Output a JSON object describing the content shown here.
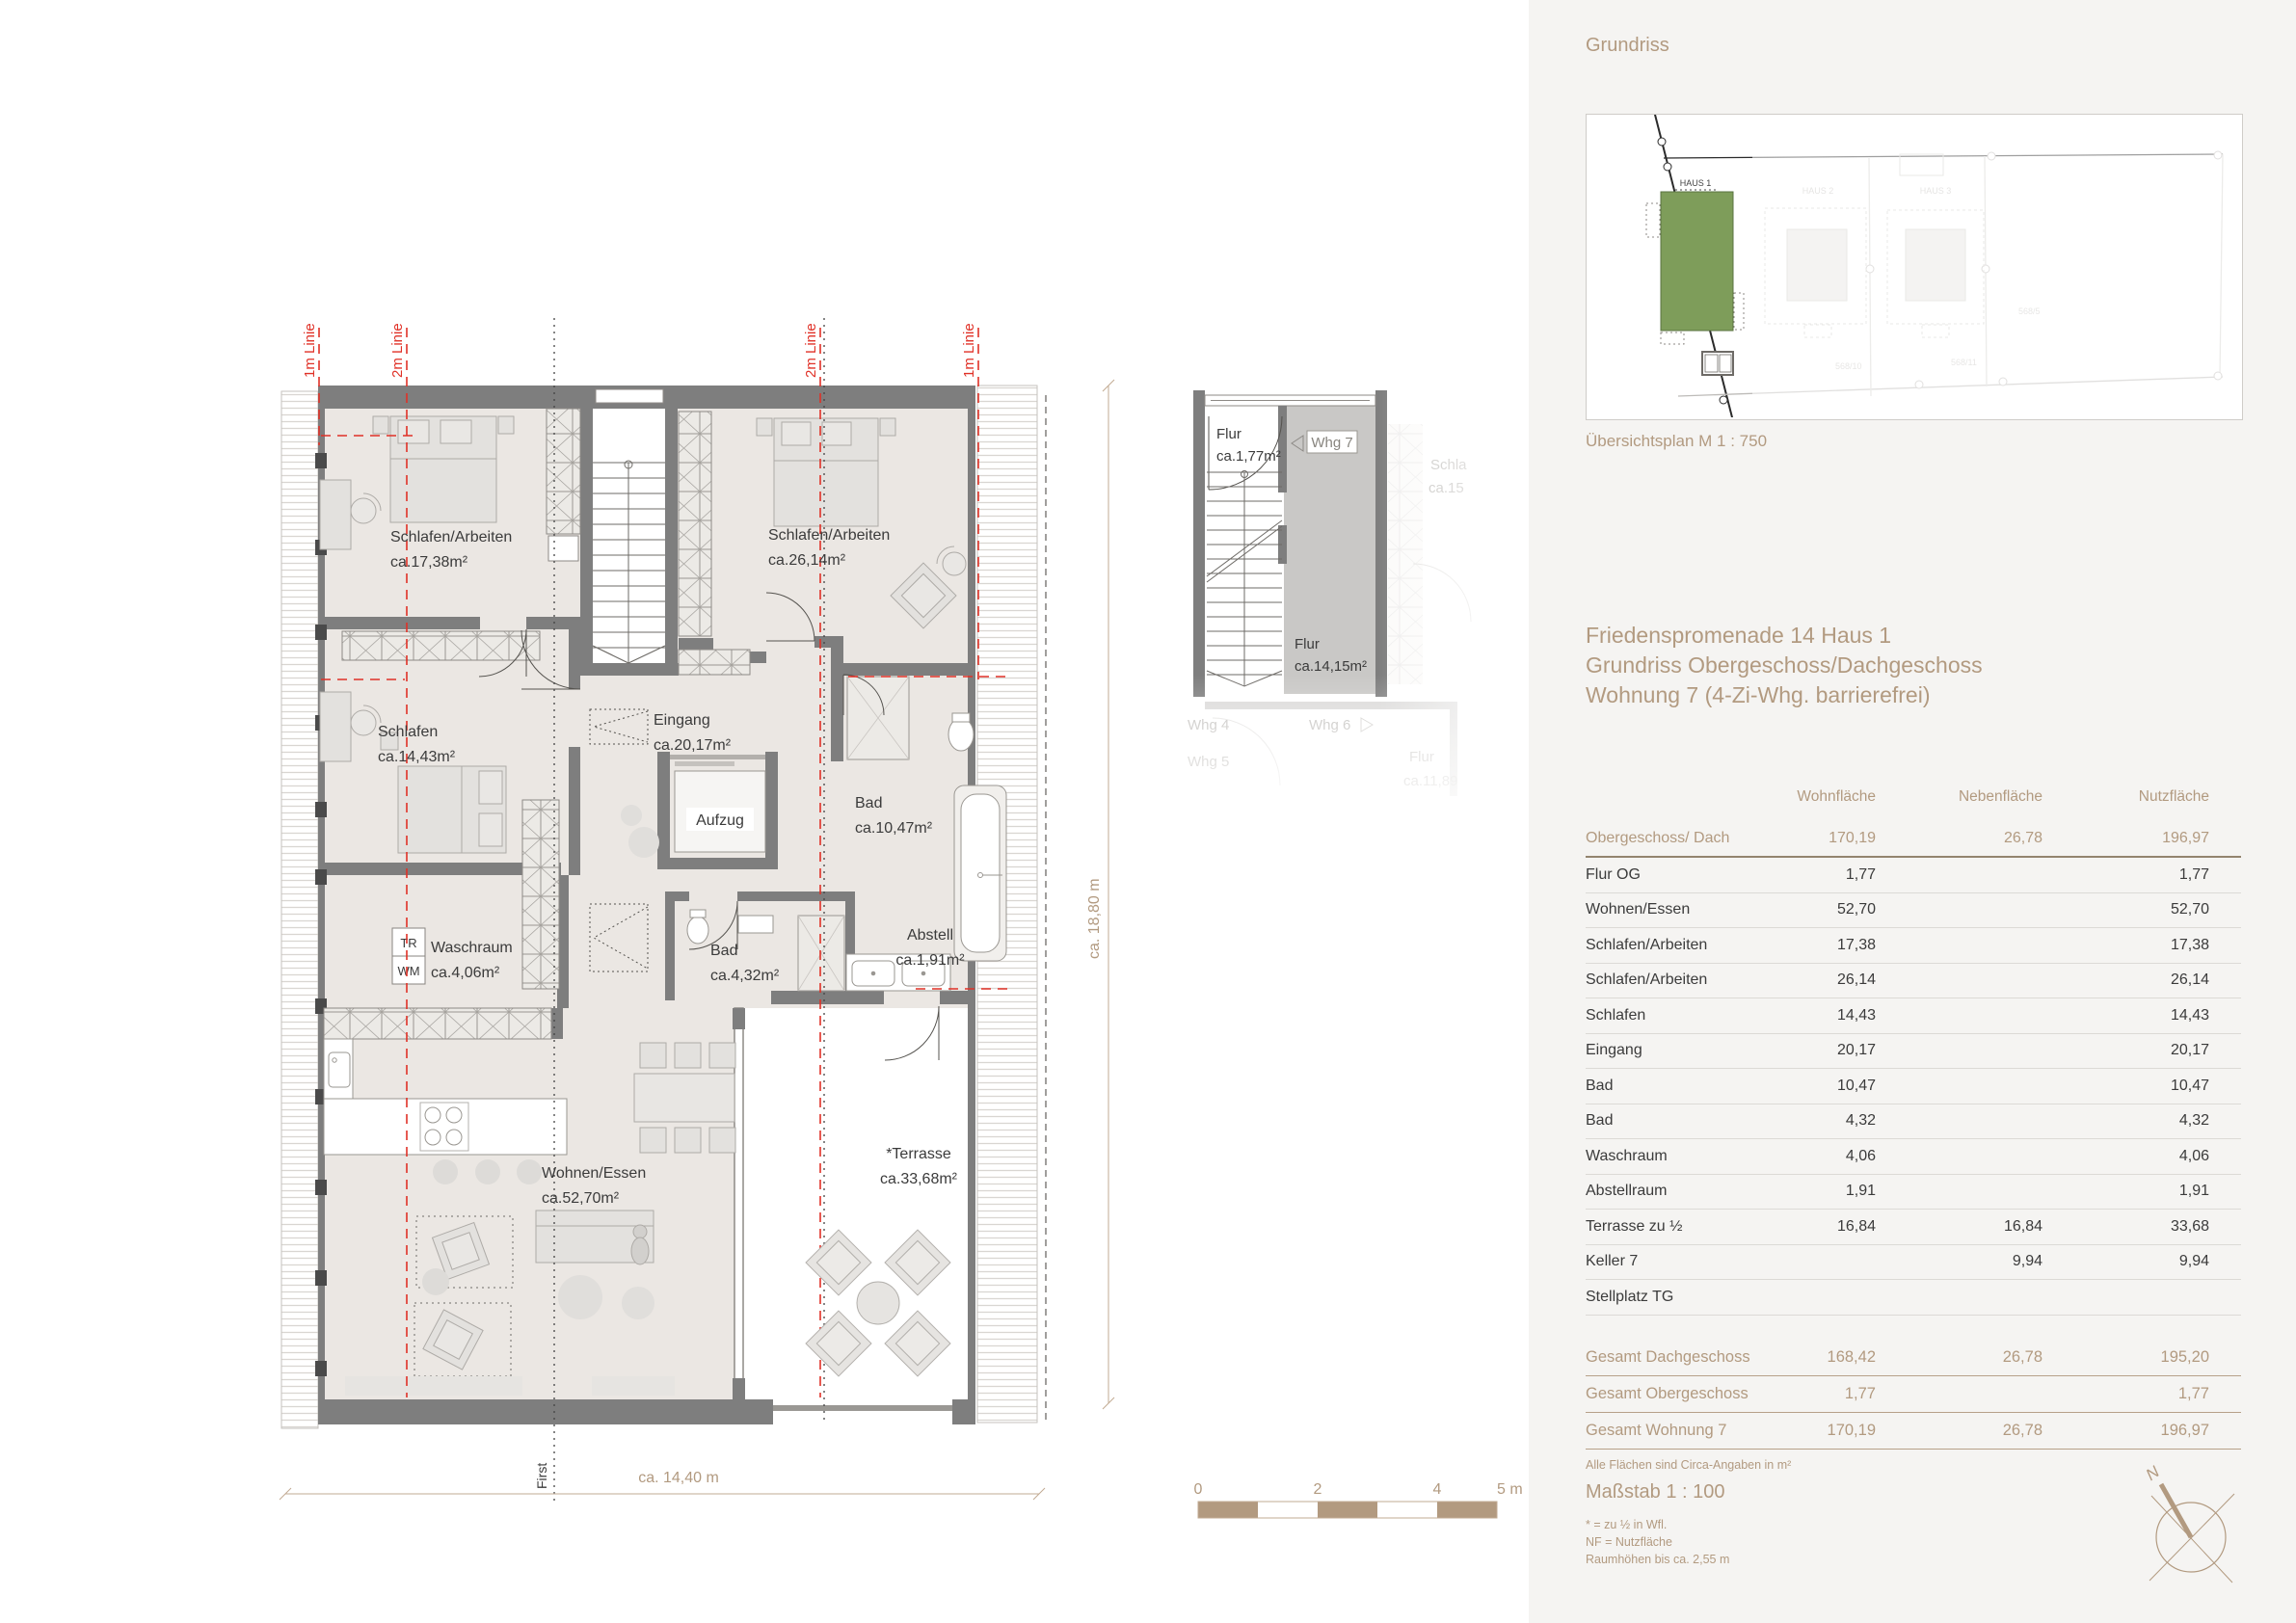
{
  "plan": {
    "rooms": [
      {
        "name": "Schlafen/Arbeiten",
        "area": "ca.17,38m²"
      },
      {
        "name": "Schlafen/Arbeiten",
        "area": "ca.26,14m²"
      },
      {
        "name": "Schlafen",
        "area": "ca.14,43m²"
      },
      {
        "name": "Eingang",
        "area": "ca.20,17m²"
      },
      {
        "name": "Bad",
        "area": "ca.10,47m²"
      },
      {
        "name": "Waschraum",
        "area": "ca.4,06m²"
      },
      {
        "name": "Bad",
        "area": "ca.4,32m²"
      },
      {
        "name": "Abstell",
        "area": "ca.1,91m²"
      },
      {
        "name": "Wohnen/Essen",
        "area": "ca.52,70m²"
      },
      {
        "name": "*Terrasse",
        "area": "ca.33,68m²"
      }
    ],
    "labels": {
      "aufzug": "Aufzug",
      "tr": "TR",
      "wm": "WM",
      "first": "First"
    },
    "guides": {
      "line_1m": "1m Linie",
      "line_2m": "2m Linie"
    },
    "dimensions": {
      "width": "ca. 14,40 m",
      "height": "ca. 18,80 m"
    }
  },
  "inset": {
    "flur_og": {
      "name": "Flur",
      "area": "ca.1,77m²"
    },
    "whg7": "Whg 7",
    "flur": {
      "name": "Flur",
      "area": "ca.14,15m²"
    },
    "faint": {
      "whg4": "Whg 4",
      "whg5": "Whg 5",
      "whg6": "Whg 6",
      "flur_name": "Flur",
      "flur_area": "ca.11,89",
      "schla": "Schla",
      "ca15": "ca.15"
    }
  },
  "scalebar": {
    "t0": "0",
    "t2": "2",
    "t4": "4",
    "t5": "5 m"
  },
  "panel": {
    "heading": "Grundriss",
    "siteplan": {
      "haus1": "HAUS 1",
      "haus2": "HAUS 2",
      "haus3": "HAUS 3",
      "street": "Friedenspromenade",
      "parcels": [
        "568/10",
        "568/11",
        "568/5"
      ]
    },
    "siteplan_caption": "Übersichtsplan M 1 : 750",
    "title_lines": [
      "Friedenspromenade 14 Haus 1",
      "Grundriss Obergeschoss/Dachgeschoss",
      "Wohnung 7 (4-Zi-Whg. barrierefrei)"
    ],
    "table": {
      "headers": [
        "Wohnfläche",
        "Nebenfläche",
        "Nutzfläche"
      ],
      "lead_row": {
        "label": "Obergeschoss/ Dach",
        "wohn": "170,19",
        "neben": "26,78",
        "nutz": "196,97"
      },
      "rows": [
        {
          "label": "Flur OG",
          "wohn": "1,77",
          "neben": "",
          "nutz": "1,77"
        },
        {
          "label": "Wohnen/Essen",
          "wohn": "52,70",
          "neben": "",
          "nutz": "52,70"
        },
        {
          "label": "Schlafen/Arbeiten",
          "wohn": "17,38",
          "neben": "",
          "nutz": "17,38"
        },
        {
          "label": "Schlafen/Arbeiten",
          "wohn": "26,14",
          "neben": "",
          "nutz": "26,14"
        },
        {
          "label": "Schlafen",
          "wohn": "14,43",
          "neben": "",
          "nutz": "14,43"
        },
        {
          "label": "Eingang",
          "wohn": "20,17",
          "neben": "",
          "nutz": "20,17"
        },
        {
          "label": "Bad",
          "wohn": "10,47",
          "neben": "",
          "nutz": "10,47"
        },
        {
          "label": "Bad",
          "wohn": "4,32",
          "neben": "",
          "nutz": "4,32"
        },
        {
          "label": "Waschraum",
          "wohn": "4,06",
          "neben": "",
          "nutz": "4,06"
        },
        {
          "label": "Abstellraum",
          "wohn": "1,91",
          "neben": "",
          "nutz": "1,91"
        },
        {
          "label": "Terrasse zu ½",
          "wohn": "16,84",
          "neben": "16,84",
          "nutz": "33,68"
        },
        {
          "label": "Keller 7",
          "wohn": "",
          "neben": "9,94",
          "nutz": "9,94"
        },
        {
          "label": "Stellplatz TG",
          "wohn": "",
          "neben": "",
          "nutz": ""
        }
      ],
      "totals": [
        {
          "label": "Gesamt Dachgeschoss",
          "wohn": "168,42",
          "neben": "26,78",
          "nutz": "195,20"
        },
        {
          "label": "Gesamt Obergeschoss",
          "wohn": "1,77",
          "neben": "",
          "nutz": "1,77"
        },
        {
          "label": "Gesamt Wohnung 7",
          "wohn": "170,19",
          "neben": "26,78",
          "nutz": "196,97"
        }
      ],
      "footnote": "Alle Flächen sind Circa-Angaben in m²"
    },
    "scale_heading": "Maßstab 1 : 100",
    "notes": [
      "* = zu ½ in Wfl.",
      "NF = Nutzfläche",
      "Raumhöhen bis ca. 2,55 m"
    ],
    "compass_n": "N"
  },
  "colors": {
    "tan": "#b29a80",
    "red": "#e03127",
    "green": "#7e9d5a",
    "wall": "#7e7e7e",
    "room_fill": "#ebe7e3",
    "panel_bg": "#f5f4f2"
  }
}
